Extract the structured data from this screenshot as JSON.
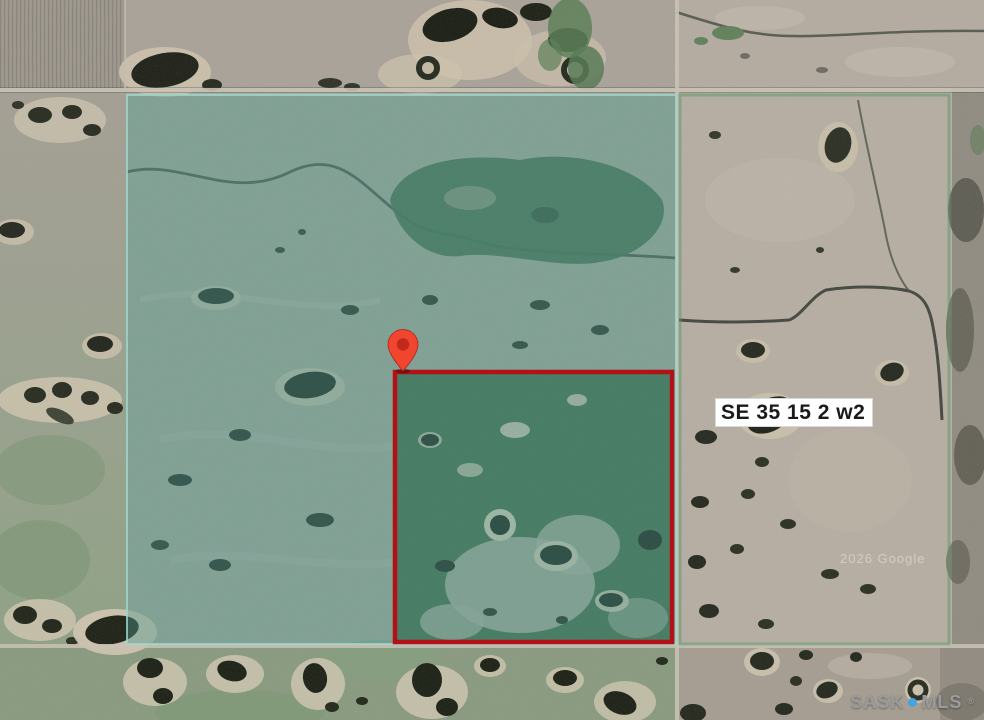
{
  "map": {
    "parcel_label": "SE 35 15 2 w2",
    "imagery_credit": "2026 Google",
    "marker_icon": "map-pin-icon",
    "watermark": {
      "brand_left": "SASK",
      "dot_icon": "dot-icon",
      "brand_right": "MLS",
      "registered": "®"
    }
  },
  "colors": {
    "overlay-fill": "#4f968c",
    "overlay-stroke": "#9fd8cd",
    "section-outline": "#5a9668",
    "parcel-outline": "#b01218",
    "pin-outer": "#f2452f",
    "pin-inner": "#c02a1a",
    "label-bg": "#ffffff",
    "label-text": "#1a1a1a",
    "watermark-gray": "#9b9b9b",
    "watermark-dot": "#42a5e0"
  }
}
